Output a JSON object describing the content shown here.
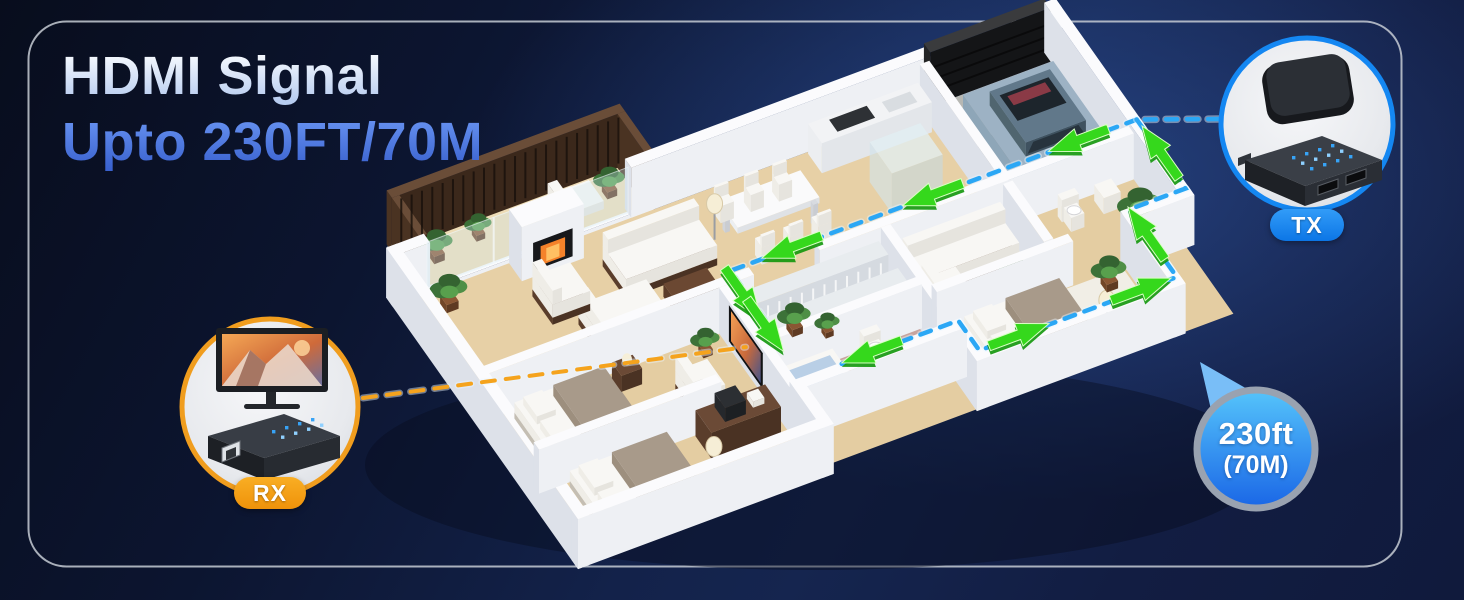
{
  "title": {
    "line1": "HDMI Signal",
    "line2": "Upto 230FT/70M"
  },
  "tx": {
    "label": "TX"
  },
  "rx": {
    "label": "RX"
  },
  "badge": {
    "distance_ft": "230ft",
    "distance_m": "(70M)"
  },
  "colors": {
    "background_navy": "#13224a",
    "title_line1": "#d9e6fa",
    "title_line2": "#4a76dd",
    "tx_accent": "#1487f2",
    "rx_accent": "#f09d1e",
    "path_blue": "#2ba7f5",
    "arrow_green": "#35d81c",
    "rx_link_orange": "#f5a31d",
    "badge_top": "#55c4fb",
    "badge_bottom": "#1a66e6",
    "border_line": "#c6cbd4"
  },
  "icons": {
    "tx_inset": "transmitter-box-and-media-player",
    "rx_inset": "receiver-box-and-monitor",
    "scene": "isometric-house-floorplan-with-signal-path"
  }
}
